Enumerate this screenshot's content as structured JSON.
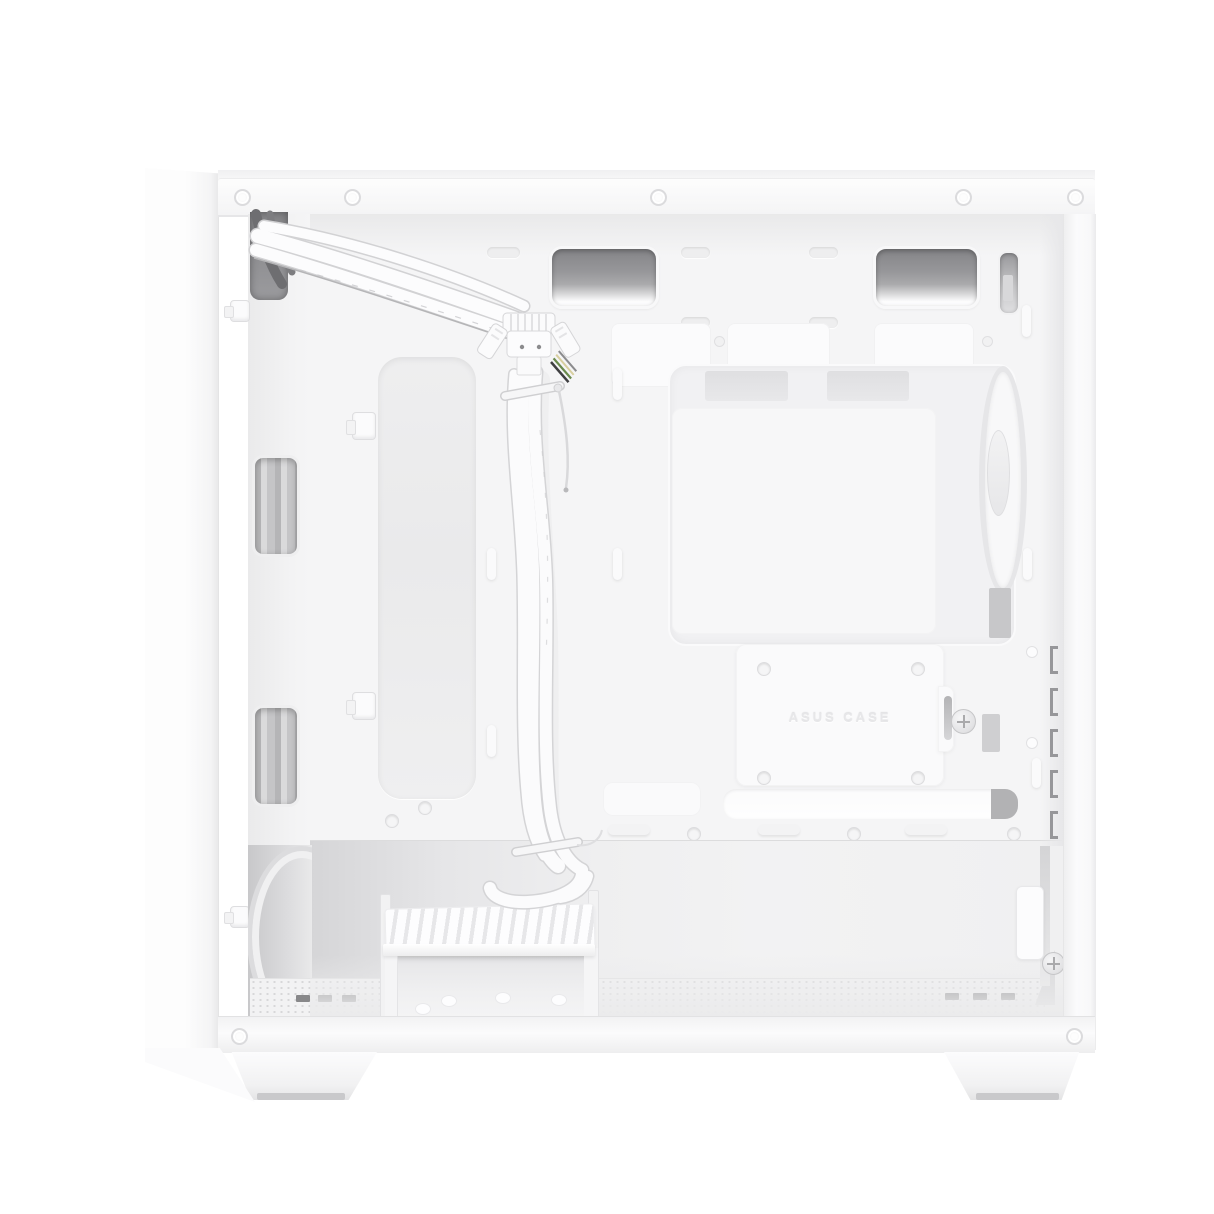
{
  "meta": {
    "kind": "product-photo",
    "description": "White mini-tower PC case photographed with the cable-management side panel removed; white flat front-panel cables are routed from a top grommet down the motherboard tray; rear exhaust fan, SSD bracket, HDD cage and mesh floor are visible.",
    "canvas": {
      "width": 1214,
      "height": 1214
    }
  },
  "visible_text": {
    "ssd_bracket_emboss": "ASUS CASE"
  },
  "colors": {
    "background": "#ffffff",
    "case_white": "#f5f5f6",
    "panel_bright": "#fbfbfc",
    "recess_gray": "#ebebec",
    "vent_dark": "#8f8f92",
    "grommet_dark": "#8b8b8e",
    "cable_white": "#fbfbfc",
    "cable_outline": "#d4d4d6",
    "psu_shadow": "#d2d2d4",
    "slot_dark": "#88888a",
    "fan_ring": "#e6e6e8"
  },
  "parts": [
    {
      "name": "front-panel-band",
      "desc": "front panel seen edge-on at left"
    },
    {
      "name": "top-rail",
      "desc": "top frame rail with five rivets"
    },
    {
      "name": "cable-grommet",
      "desc": "dark routing hole, top left"
    },
    {
      "name": "front-panel-cable-bundle",
      "desc": "white flat ribbon cables with two zip ties"
    },
    {
      "name": "usb3-header-connector",
      "desc": "large white internal header plug"
    },
    {
      "name": "front-panel-wires",
      "desc": "small colored header wires"
    },
    {
      "name": "long-routing-cutout",
      "desc": "tall rounded recess in tray"
    },
    {
      "name": "front-fan-cutouts",
      "desc": "two openings showing gray front fans"
    },
    {
      "name": "cpu-cutout-window",
      "desc": "large opening in motherboard tray"
    },
    {
      "name": "rear-exhaust-fan",
      "desc": "fan seen edge-on through window"
    },
    {
      "name": "ssd-bracket",
      "desc": "embossed bracket plate with four screws and thumbscrew"
    },
    {
      "name": "cable-routing-slot",
      "desc": "long slot above PSU shroud with gray grommet end"
    },
    {
      "name": "psu-compartment",
      "desc": "lower bay with mesh floor"
    },
    {
      "name": "hdd-cage",
      "desc": "drive cage with slatted tray"
    },
    {
      "name": "expansion-slot-tabs",
      "desc": "five dark tabs on rear edge"
    },
    {
      "name": "case-feet",
      "desc": "two trapezoid feet with dark pads"
    }
  ]
}
